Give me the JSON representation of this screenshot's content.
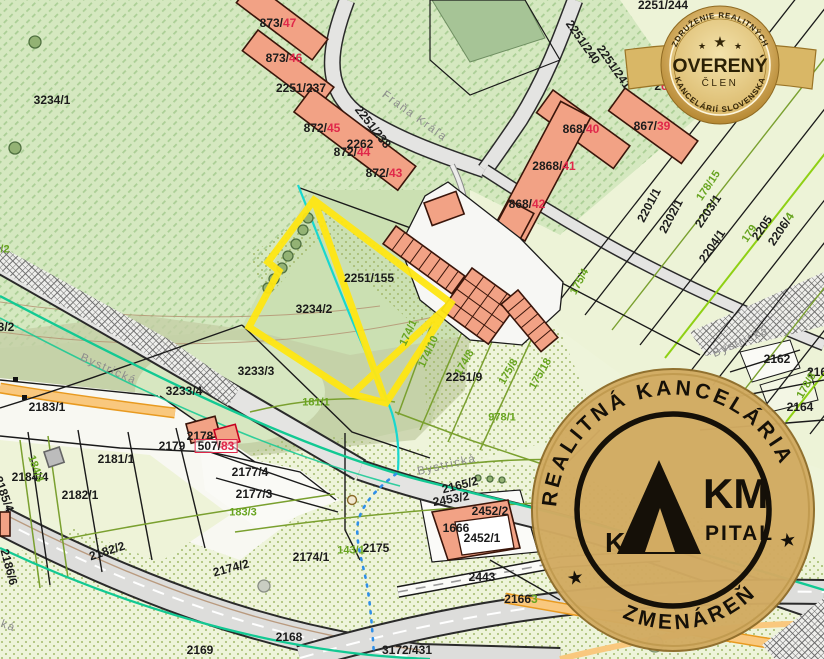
{
  "colors": {
    "highlight_yellow": "#ffe713",
    "red_label": "#e0284a",
    "green_label": "#67a41f",
    "black_label": "#1b1b1b",
    "street_label": "#8d8d8d",
    "building_fill": "#f2a285",
    "road_fill": "#e4e4e2",
    "utility_teal": "#12c993",
    "stream_cyan": "#18d7cf",
    "stream_blue": "#2f8fe8",
    "badge_gold": "#d8b568",
    "stamp_gold": "#d2ab62"
  },
  "map": {
    "labels": [
      {
        "t": "Fraňa Kráľa",
        "x": 414,
        "y": 117,
        "r": 36,
        "c": "s"
      },
      {
        "t": "Bystrická",
        "x": 108,
        "y": 370,
        "r": 24,
        "c": "s"
      },
      {
        "t": "Bystrická",
        "x": 447,
        "y": 466,
        "r": -13,
        "c": "s"
      },
      {
        "t": "Bystrická",
        "x": 741,
        "y": 343,
        "r": -24,
        "c": "s"
      },
      {
        "t": "ká",
        "x": 8,
        "y": 627,
        "r": 20,
        "c": "s"
      },
      {
        "t": "3234/1",
        "x": 52,
        "y": 100,
        "c": "b"
      },
      {
        "t": "2251/237",
        "x": 301,
        "y": 88,
        "c": "b"
      },
      {
        "p": [
          [
            "873/",
            "#1b1b1b"
          ],
          [
            "47",
            "#e0284a"
          ]
        ],
        "x": 278,
        "y": 23,
        "c": "b"
      },
      {
        "p": [
          [
            "873/",
            "#1b1b1b"
          ],
          [
            "46",
            "#e0284a"
          ]
        ],
        "x": 284,
        "y": 58,
        "c": "b"
      },
      {
        "p": [
          [
            "872/",
            "#1b1b1b"
          ],
          [
            "45",
            "#e0284a"
          ]
        ],
        "x": 322,
        "y": 128,
        "c": "b"
      },
      {
        "t": "2262",
        "x": 360,
        "y": 144,
        "c": "b"
      },
      {
        "p": [
          [
            "872/",
            "#1b1b1b"
          ],
          [
            "44",
            "#e0284a"
          ]
        ],
        "x": 352,
        "y": 152,
        "c": "b"
      },
      {
        "p": [
          [
            "872/",
            "#1b1b1b"
          ],
          [
            "43",
            "#e0284a"
          ]
        ],
        "x": 384,
        "y": 173,
        "c": "b"
      },
      {
        "t": "2251/238",
        "x": 373,
        "y": 127,
        "r": 52,
        "c": "b"
      },
      {
        "t": "2251/240",
        "x": 583,
        "y": 42,
        "r": 55,
        "c": "b"
      },
      {
        "t": "2251/241",
        "x": 614,
        "y": 67,
        "r": 55,
        "c": "b"
      },
      {
        "t": "2251/244",
        "x": 663,
        "y": 5,
        "c": "b"
      },
      {
        "p": [
          [
            "868/",
            "#1b1b1b"
          ],
          [
            "40",
            "#e0284a"
          ]
        ],
        "x": 581,
        "y": 129,
        "c": "b"
      },
      {
        "p": [
          [
            "867/",
            "#1b1b1b"
          ],
          [
            "39",
            "#e0284a"
          ]
        ],
        "x": 652,
        "y": 126,
        "c": "b"
      },
      {
        "p": [
          [
            "2",
            "#1b1b1b"
          ],
          [
            "6",
            "#e0284a"
          ]
        ],
        "x": 661,
        "y": 86,
        "c": "b"
      },
      {
        "p": [
          [
            "2868/",
            "#1b1b1b"
          ],
          [
            "41",
            "#e0284a"
          ]
        ],
        "x": 554,
        "y": 166,
        "c": "b"
      },
      {
        "p": [
          [
            "868/",
            "#1b1b1b"
          ],
          [
            "42",
            "#e0284a"
          ]
        ],
        "x": 527,
        "y": 204,
        "c": "b"
      },
      {
        "t": "2251/155",
        "x": 369,
        "y": 278,
        "c": "b"
      },
      {
        "t": "3234/2",
        "x": 314,
        "y": 309,
        "c": "b"
      },
      {
        "t": "3233/3",
        "x": 256,
        "y": 371,
        "c": "b"
      },
      {
        "t": "3233/4",
        "x": 184,
        "y": 391,
        "c": "b"
      },
      {
        "t": "3/2",
        "x": 6,
        "y": 327,
        "c": "b"
      },
      {
        "t": "2251/9",
        "x": 464,
        "y": 377,
        "c": "b"
      },
      {
        "t": "2162",
        "x": 777,
        "y": 359,
        "c": "b"
      },
      {
        "t": "216",
        "x": 817,
        "y": 372,
        "c": "b"
      },
      {
        "t": "2164",
        "x": 800,
        "y": 407,
        "c": "b"
      },
      {
        "t": "2201/1",
        "x": 649,
        "y": 205,
        "r": -62,
        "c": "b"
      },
      {
        "t": "2202/1",
        "x": 671,
        "y": 216,
        "r": -62,
        "c": "b"
      },
      {
        "t": "2203/1",
        "x": 708,
        "y": 211,
        "r": -56,
        "c": "b"
      },
      {
        "t": "2204/1",
        "x": 712,
        "y": 246,
        "r": -56,
        "c": "b"
      },
      {
        "t": "2205",
        "x": 762,
        "y": 228,
        "r": -56,
        "c": "b"
      },
      {
        "p": [
          [
            "2206/",
            "#1b1b1b"
          ],
          [
            "4",
            "#67a41f"
          ]
        ],
        "x": 781,
        "y": 229,
        "r": -56,
        "c": "b"
      },
      {
        "t": "2183/1",
        "x": 47,
        "y": 407,
        "c": "b"
      },
      {
        "t": "2178",
        "x": 200,
        "y": 436,
        "c": "b"
      },
      {
        "t": "2179",
        "x": 172,
        "y": 446,
        "c": "b"
      },
      {
        "p": [
          [
            "507/",
            "#1b1b1b"
          ],
          [
            "83",
            "#e0284a"
          ]
        ],
        "x": 216,
        "y": 446,
        "c": "b",
        "box": true
      },
      {
        "t": "2181/1",
        "x": 116,
        "y": 459,
        "c": "b"
      },
      {
        "t": "2184/4",
        "x": 30,
        "y": 477,
        "c": "b"
      },
      {
        "t": "2182/1",
        "x": 80,
        "y": 495,
        "c": "b"
      },
      {
        "t": "2182/2",
        "x": 107,
        "y": 551,
        "r": -18,
        "c": "b"
      },
      {
        "t": "2186/6",
        "x": 9,
        "y": 567,
        "r": 75,
        "c": "b"
      },
      {
        "t": "2185/4",
        "x": 4,
        "y": 494,
        "r": 70,
        "c": "b"
      },
      {
        "t": "2177/4",
        "x": 250,
        "y": 472,
        "c": "b"
      },
      {
        "t": "2177/3",
        "x": 254,
        "y": 494,
        "c": "b"
      },
      {
        "t": "2174/2",
        "x": 231,
        "y": 568,
        "r": -15,
        "c": "b"
      },
      {
        "t": "2174/1",
        "x": 311,
        "y": 557,
        "c": "b"
      },
      {
        "t": "2175",
        "x": 376,
        "y": 548,
        "c": "b"
      },
      {
        "t": "2165/2",
        "x": 460,
        "y": 485,
        "r": -14,
        "c": "b"
      },
      {
        "t": "2453/2",
        "x": 451,
        "y": 499,
        "r": -10,
        "c": "b"
      },
      {
        "t": "2452/2",
        "x": 490,
        "y": 511,
        "c": "b"
      },
      {
        "t": "1666",
        "x": 456,
        "y": 528,
        "c": "b"
      },
      {
        "t": "2452/1",
        "x": 482,
        "y": 538,
        "c": "b"
      },
      {
        "t": "2443",
        "x": 482,
        "y": 577,
        "c": "b"
      },
      {
        "p": [
          [
            "2166",
            "#1b1b1b"
          ],
          [
            "3",
            "#67a41f"
          ]
        ],
        "x": 521,
        "y": 599,
        "c": "b"
      },
      {
        "t": "2168",
        "x": 289,
        "y": 637,
        "c": "b"
      },
      {
        "t": "2169",
        "x": 200,
        "y": 650,
        "c": "b"
      },
      {
        "t": "3172/431",
        "x": 407,
        "y": 650,
        "c": "b"
      },
      {
        "t": "/2",
        "x": 5,
        "y": 250,
        "c": "g"
      },
      {
        "t": "181/1",
        "x": 316,
        "y": 403,
        "c": "g"
      },
      {
        "t": "174/1",
        "x": 409,
        "y": 333,
        "r": -65,
        "c": "g"
      },
      {
        "t": "174/10",
        "x": 429,
        "y": 352,
        "r": -65,
        "c": "g"
      },
      {
        "t": "174/8",
        "x": 465,
        "y": 363,
        "r": -60,
        "c": "g"
      },
      {
        "t": "175/8",
        "x": 509,
        "y": 372,
        "r": -60,
        "c": "g"
      },
      {
        "t": "175/18",
        "x": 541,
        "y": 374,
        "r": -60,
        "c": "g"
      },
      {
        "t": "978/1",
        "x": 502,
        "y": 418,
        "c": "g"
      },
      {
        "t": "183/3",
        "x": 243,
        "y": 513,
        "c": "g"
      },
      {
        "t": "143/1",
        "x": 351,
        "y": 551,
        "c": "g"
      },
      {
        "t": "184/4",
        "x": 35,
        "y": 469,
        "r": 70,
        "c": "g"
      },
      {
        "t": "175/4",
        "x": 580,
        "y": 282,
        "r": -62,
        "c": "g"
      },
      {
        "t": "178/15",
        "x": 709,
        "y": 186,
        "r": -56,
        "c": "g"
      },
      {
        "t": "179",
        "x": 750,
        "y": 234,
        "r": -56,
        "c": "g"
      },
      {
        "t": "178/8",
        "x": 807,
        "y": 386,
        "r": -60,
        "c": "g"
      }
    ]
  },
  "badge": {
    "top_arc": "ZDRUŽENIE REALITNÝCH",
    "center": "OVERENÝ",
    "sub": "ČLEN",
    "bottom_arc": "KANCELÁRIÍ SLOVENSKA",
    "star_big": "★",
    "star_small_left": "★",
    "star_small_right": "★"
  },
  "stamp": {
    "top_arc": "REALITNÁ KANCELÁRIA",
    "bottom_arc": "ZMENÁREŇ",
    "star_left": "★",
    "star_right": "★",
    "logo_k": "K",
    "logo_km": "KM",
    "logo_pital": "PITAL"
  }
}
